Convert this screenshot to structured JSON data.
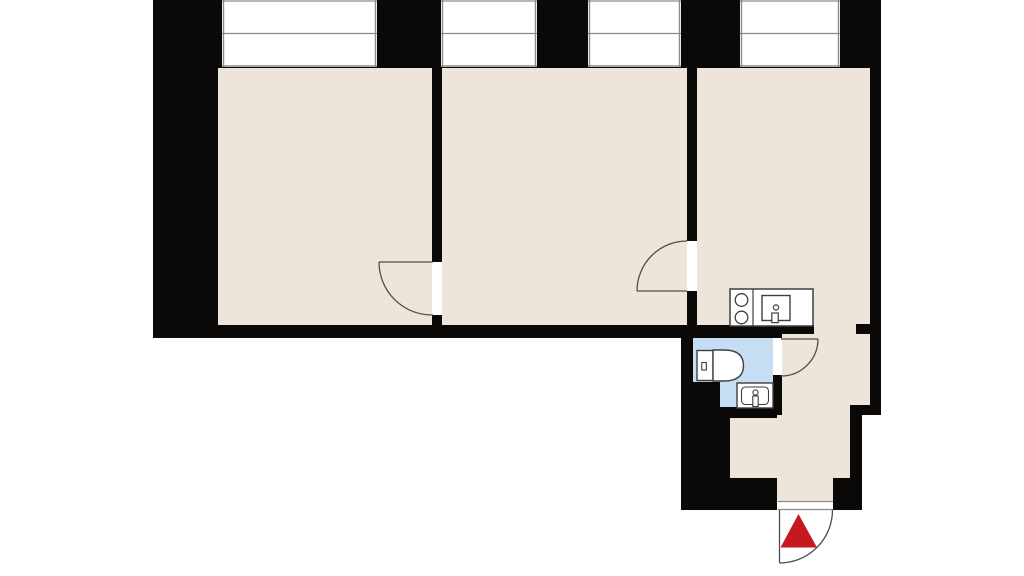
{
  "meta": {
    "description": "apartment floor plan, no text labels",
    "canvas": {
      "width": 1024,
      "height": 576
    }
  },
  "colors": {
    "background": "#ffffff",
    "wall": "#0a0908",
    "floor": "#ede5da",
    "bath": "#c5def3",
    "white": "#ffffff",
    "window_line": "#8a8a8a",
    "door_line": "#4e4e4e",
    "fixture_line": "#3f3f3f",
    "marker": "#c5181f"
  },
  "plan": {
    "elements": [
      {
        "name": "room-left-floor",
        "kind": "rect",
        "x": 218,
        "y": 67,
        "w": 215,
        "h": 271,
        "fill": "$floor"
      },
      {
        "name": "room-middle-floor",
        "kind": "rect",
        "x": 441,
        "y": 67,
        "w": 247,
        "h": 271,
        "fill": "$floor"
      },
      {
        "name": "room-right-floor",
        "kind": "rect",
        "x": 696,
        "y": 67,
        "w": 174,
        "h": 271,
        "fill": "$floor"
      },
      {
        "name": "corridor-floor",
        "kind": "rect",
        "x": 782,
        "y": 334,
        "w": 88,
        "h": 81,
        "fill": "$floor"
      },
      {
        "name": "hallway-floor",
        "kind": "rect",
        "x": 730,
        "y": 415,
        "w": 120,
        "h": 63,
        "fill": "$floor"
      },
      {
        "name": "vestibule-floor",
        "kind": "rect",
        "x": 777,
        "y": 478,
        "w": 56,
        "h": 24,
        "fill": "$floor"
      },
      {
        "name": "bathroom-floor",
        "kind": "rect",
        "x": 693,
        "y": 338,
        "w": 80,
        "h": 70,
        "fill": "$bath"
      },
      {
        "name": "top-wall",
        "kind": "rect",
        "x": 153,
        "y": 0,
        "w": 728,
        "h": 68,
        "fill": "$wall"
      },
      {
        "name": "left-wall",
        "kind": "rect",
        "x": 153,
        "y": 0,
        "w": 65,
        "h": 338,
        "fill": "$wall"
      },
      {
        "name": "bottom-wall-main",
        "kind": "rect",
        "x": 153,
        "y": 325,
        "w": 544,
        "h": 13,
        "fill": "$wall"
      },
      {
        "name": "bathroom-top-wall",
        "kind": "rect",
        "x": 681,
        "y": 325,
        "w": 101,
        "h": 13,
        "fill": "$wall"
      },
      {
        "name": "kitchen-bottom-wall",
        "kind": "rect",
        "x": 782,
        "y": 325,
        "w": 32,
        "h": 9,
        "fill": "$wall"
      },
      {
        "name": "partition-wall-left",
        "kind": "rect",
        "x": 432,
        "y": 67,
        "w": 10,
        "h": 258,
        "fill": "$wall"
      },
      {
        "name": "partition-wall-right",
        "kind": "rect",
        "x": 687,
        "y": 67,
        "w": 10,
        "h": 258,
        "fill": "$wall"
      },
      {
        "name": "right-wall",
        "kind": "rect",
        "x": 870,
        "y": 0,
        "w": 11,
        "h": 415,
        "fill": "$wall"
      },
      {
        "name": "right-wall-step",
        "kind": "rect",
        "x": 850,
        "y": 405,
        "w": 31,
        "h": 10,
        "fill": "$wall"
      },
      {
        "name": "right-wall-lower",
        "kind": "rect",
        "x": 850,
        "y": 415,
        "w": 12,
        "h": 65,
        "fill": "$wall"
      },
      {
        "name": "entry-right-block",
        "kind": "rect",
        "x": 833,
        "y": 478,
        "w": 29,
        "h": 32,
        "fill": "$wall"
      },
      {
        "name": "passage-wall-stub",
        "kind": "rect",
        "x": 856,
        "y": 324,
        "w": 15,
        "h": 10,
        "fill": "$wall"
      },
      {
        "name": "bathroom-left-wall",
        "kind": "rect",
        "x": 681,
        "y": 325,
        "w": 12,
        "h": 82,
        "fill": "$wall"
      },
      {
        "name": "bottom-left-block",
        "kind": "rect",
        "x": 681,
        "y": 407,
        "w": 49,
        "h": 103,
        "fill": "$wall"
      },
      {
        "name": "under-sink-wall",
        "kind": "rect",
        "x": 730,
        "y": 407,
        "w": 47,
        "h": 11,
        "fill": "$wall"
      },
      {
        "name": "entry-left-block",
        "kind": "rect",
        "x": 681,
        "y": 478,
        "w": 96,
        "h": 32,
        "fill": "$wall"
      },
      {
        "name": "bathroom-right-wall",
        "kind": "rect",
        "x": 773,
        "y": 338,
        "w": 9,
        "h": 77,
        "fill": "$wall"
      },
      {
        "name": "bathroom-floor-step",
        "kind": "rect",
        "x": 693,
        "y": 382,
        "w": 27,
        "h": 26,
        "fill": "$wall"
      },
      {
        "name": "window-1",
        "kind": "rect",
        "x": 222,
        "y": 0,
        "w": 155,
        "h": 67,
        "fill": "$white"
      },
      {
        "name": "window-1-frame-left",
        "kind": "line",
        "x1": 223.5,
        "y1": 0,
        "x2": 223.5,
        "y2": 67,
        "stroke": "$window_line",
        "sw": 1.4
      },
      {
        "name": "window-1-frame-right",
        "kind": "line",
        "x1": 375.5,
        "y1": 0,
        "x2": 375.5,
        "y2": 67,
        "stroke": "$window_line",
        "sw": 1.4
      },
      {
        "name": "window-1-frame-top",
        "kind": "line",
        "x1": 222,
        "y1": 1,
        "x2": 377,
        "y2": 1,
        "stroke": "$window_line",
        "sw": 1.2
      },
      {
        "name": "window-1-mullion",
        "kind": "line",
        "x1": 222,
        "y1": 33.5,
        "x2": 377,
        "y2": 33.5,
        "stroke": "$window_line",
        "sw": 1.2
      },
      {
        "name": "window-1-sill",
        "kind": "line",
        "x1": 222,
        "y1": 66,
        "x2": 377,
        "y2": 66,
        "stroke": "$window_line",
        "sw": 1.4
      },
      {
        "name": "window-2",
        "kind": "rect",
        "x": 441,
        "y": 0,
        "w": 96,
        "h": 67,
        "fill": "$white"
      },
      {
        "name": "window-2-frame-left",
        "kind": "line",
        "x1": 442.5,
        "y1": 0,
        "x2": 442.5,
        "y2": 67,
        "stroke": "$window_line",
        "sw": 1.4
      },
      {
        "name": "window-2-frame-right",
        "kind": "line",
        "x1": 535.5,
        "y1": 0,
        "x2": 535.5,
        "y2": 67,
        "stroke": "$window_line",
        "sw": 1.4
      },
      {
        "name": "window-2-frame-top",
        "kind": "line",
        "x1": 441,
        "y1": 1,
        "x2": 537,
        "y2": 1,
        "stroke": "$window_line",
        "sw": 1.2
      },
      {
        "name": "window-2-mullion",
        "kind": "line",
        "x1": 441,
        "y1": 33.5,
        "x2": 537,
        "y2": 33.5,
        "stroke": "$window_line",
        "sw": 1.2
      },
      {
        "name": "window-2-sill",
        "kind": "line",
        "x1": 441,
        "y1": 66,
        "x2": 537,
        "y2": 66,
        "stroke": "$window_line",
        "sw": 1.4
      },
      {
        "name": "window-3",
        "kind": "rect",
        "x": 588,
        "y": 0,
        "w": 93,
        "h": 67,
        "fill": "$white"
      },
      {
        "name": "window-3-frame-left",
        "kind": "line",
        "x1": 589.5,
        "y1": 0,
        "x2": 589.5,
        "y2": 67,
        "stroke": "$window_line",
        "sw": 1.4
      },
      {
        "name": "window-3-frame-right",
        "kind": "line",
        "x1": 679.5,
        "y1": 0,
        "x2": 679.5,
        "y2": 67,
        "stroke": "$window_line",
        "sw": 1.4
      },
      {
        "name": "window-3-frame-top",
        "kind": "line",
        "x1": 588,
        "y1": 1,
        "x2": 681,
        "y2": 1,
        "stroke": "$window_line",
        "sw": 1.2
      },
      {
        "name": "window-3-mullion",
        "kind": "line",
        "x1": 588,
        "y1": 33.5,
        "x2": 681,
        "y2": 33.5,
        "stroke": "$window_line",
        "sw": 1.2
      },
      {
        "name": "window-3-sill",
        "kind": "line",
        "x1": 588,
        "y1": 66,
        "x2": 681,
        "y2": 66,
        "stroke": "$window_line",
        "sw": 1.4
      },
      {
        "name": "window-4",
        "kind": "rect",
        "x": 740,
        "y": 0,
        "w": 100,
        "h": 67,
        "fill": "$white"
      },
      {
        "name": "window-4-frame-left",
        "kind": "line",
        "x1": 741.5,
        "y1": 0,
        "x2": 741.5,
        "y2": 67,
        "stroke": "$window_line",
        "sw": 1.4
      },
      {
        "name": "window-4-frame-right",
        "kind": "line",
        "x1": 838.5,
        "y1": 0,
        "x2": 838.5,
        "y2": 67,
        "stroke": "$window_line",
        "sw": 1.4
      },
      {
        "name": "window-4-frame-top",
        "kind": "line",
        "x1": 740,
        "y1": 1,
        "x2": 840,
        "y2": 1,
        "stroke": "$window_line",
        "sw": 1.2
      },
      {
        "name": "window-4-mullion",
        "kind": "line",
        "x1": 740,
        "y1": 33.5,
        "x2": 840,
        "y2": 33.5,
        "stroke": "$window_line",
        "sw": 1.2
      },
      {
        "name": "window-4-sill",
        "kind": "line",
        "x1": 740,
        "y1": 66,
        "x2": 840,
        "y2": 66,
        "stroke": "$window_line",
        "sw": 1.4
      },
      {
        "name": "door-opening-left",
        "kind": "rect",
        "x": 432,
        "y": 262,
        "w": 10,
        "h": 53,
        "fill": "$white"
      },
      {
        "name": "door-opening-right",
        "kind": "rect",
        "x": 687,
        "y": 241,
        "w": 10,
        "h": 50,
        "fill": "$white"
      },
      {
        "name": "bathroom-door-opening",
        "kind": "rect",
        "x": 773,
        "y": 338,
        "w": 9,
        "h": 37,
        "fill": "$white"
      },
      {
        "name": "entrance-door-opening",
        "kind": "rect",
        "x": 778,
        "y": 501,
        "w": 55,
        "h": 9,
        "fill": "$white"
      },
      {
        "name": "entrance-threshold-outer",
        "kind": "line",
        "x1": 778,
        "y1": 501.5,
        "x2": 833,
        "y2": 501.5,
        "stroke": "$window_line",
        "sw": 1.2
      },
      {
        "name": "entrance-threshold-inner",
        "kind": "line",
        "x1": 778,
        "y1": 509.5,
        "x2": 833,
        "y2": 509.5,
        "stroke": "$window_line",
        "sw": 1.2
      },
      {
        "name": "door-left-leaf",
        "kind": "line",
        "x1": 379,
        "y1": 262,
        "x2": 433,
        "y2": 262,
        "stroke": "$door_line",
        "sw": 1.3
      },
      {
        "name": "door-left-swing-arc",
        "kind": "path",
        "d": "M 379 262 A 53 53 0 0 0 433 315",
        "stroke": "$door_line",
        "sw": 1.3
      },
      {
        "name": "door-right-leaf",
        "kind": "line",
        "x1": 637,
        "y1": 291,
        "x2": 687,
        "y2": 291,
        "stroke": "$door_line",
        "sw": 1.3
      },
      {
        "name": "door-right-swing-arc",
        "kind": "path",
        "d": "M 637 291 A 50 50 0 0 1 687 241",
        "stroke": "$door_line",
        "sw": 1.3
      },
      {
        "name": "bathroom-door-leaf",
        "kind": "line",
        "x1": 781,
        "y1": 339,
        "x2": 818,
        "y2": 339,
        "stroke": "$door_line",
        "sw": 1.3
      },
      {
        "name": "bathroom-door-swing-arc",
        "kind": "path",
        "d": "M 818 339 A 37 37 0 0 1 781 376",
        "stroke": "$door_line",
        "sw": 1.3
      },
      {
        "name": "entrance-door-leaf",
        "kind": "line",
        "x1": 779.5,
        "y1": 510,
        "x2": 779.5,
        "y2": 563,
        "stroke": "$door_line",
        "sw": 1.3
      },
      {
        "name": "entrance-door-swing-arc",
        "kind": "path",
        "d": "M 779.5 563 A 53 53 0 0 0 832.5 510",
        "stroke": "$door_line",
        "sw": 1.3
      },
      {
        "name": "kitchen-counter",
        "kind": "rect",
        "x": 730,
        "y": 289,
        "w": 83,
        "h": 37,
        "fill": "$white",
        "stroke": "$fixture_line",
        "sw": 1.5
      },
      {
        "name": "kitchen-counter-divider",
        "kind": "line",
        "x1": 753,
        "y1": 289,
        "x2": 753,
        "y2": 326,
        "stroke": "$fixture_line",
        "sw": 1.2
      },
      {
        "name": "stove-burner-top",
        "kind": "circle",
        "cx": 741.5,
        "cy": 300,
        "r": 6.3,
        "fill": "$white",
        "stroke": "$fixture_line",
        "sw": 1.3
      },
      {
        "name": "stove-burner-bottom",
        "kind": "circle",
        "cx": 741.5,
        "cy": 317.5,
        "r": 6.3,
        "fill": "$white",
        "stroke": "$fixture_line",
        "sw": 1.3
      },
      {
        "name": "kitchen-sink",
        "kind": "rect",
        "x": 762,
        "y": 295.5,
        "w": 28,
        "h": 25,
        "fill": "$white",
        "stroke": "$fixture_line",
        "sw": 1.4
      },
      {
        "name": "kitchen-sink-drain",
        "kind": "circle",
        "cx": 776,
        "cy": 307.5,
        "r": 2.6,
        "fill": "$white",
        "stroke": "$fixture_line",
        "sw": 1.2
      },
      {
        "name": "kitchen-sink-faucet",
        "kind": "rect",
        "x": 771.8,
        "y": 313,
        "w": 6.4,
        "h": 9.6,
        "fill": "$white",
        "stroke": "$fixture_line",
        "sw": 1.2
      },
      {
        "name": "toilet-tank",
        "kind": "rect",
        "x": 697,
        "y": 350.5,
        "w": 16,
        "h": 30,
        "fill": "$white",
        "stroke": "$fixture_line",
        "sw": 1.4
      },
      {
        "name": "toilet-flush-button",
        "kind": "rect",
        "x": 701.8,
        "y": 362.5,
        "w": 4.5,
        "h": 7.5,
        "fill": "$white",
        "stroke": "$fixture_line",
        "sw": 1.1
      },
      {
        "name": "toilet-bowl",
        "kind": "path",
        "d": "M 713 350 L 724 350 Q 743.5 350 743.5 365.5 Q 743.5 381 724 381 L 713 381 Z",
        "fill": "$white",
        "stroke": "$fixture_line",
        "sw": 1.4
      },
      {
        "name": "washbasin-box",
        "kind": "rect",
        "x": 737,
        "y": 383,
        "w": 36,
        "h": 25,
        "fill": "$white",
        "stroke": "$fixture_line",
        "sw": 1.4
      },
      {
        "name": "washbasin-basin",
        "kind": "rect",
        "x": 741.5,
        "y": 387,
        "w": 27,
        "h": 17.5,
        "rx": 4,
        "fill": "none",
        "stroke": "$fixture_line",
        "sw": 1.1
      },
      {
        "name": "washbasin-tap-head",
        "kind": "circle",
        "cx": 755.5,
        "cy": 392.5,
        "r": 2.6,
        "fill": "$white",
        "stroke": "$fixture_line",
        "sw": 1.1
      },
      {
        "name": "washbasin-tap-body",
        "kind": "rect",
        "x": 752.8,
        "y": 396,
        "w": 5.4,
        "h": 10.5,
        "fill": "$white",
        "stroke": "$fixture_line",
        "sw": 1.1
      },
      {
        "name": "entrance-marker-triangle",
        "kind": "polygon",
        "points": "798.5,514 780.5,547.5 817,547.5",
        "fill": "$marker"
      }
    ]
  }
}
